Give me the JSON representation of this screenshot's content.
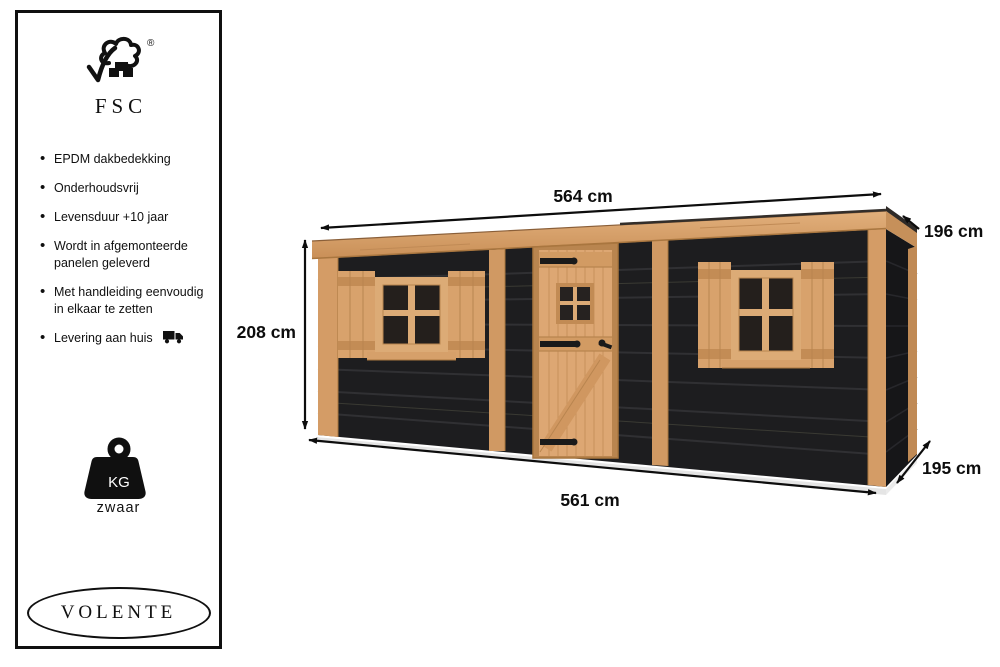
{
  "sidebar": {
    "certification": {
      "name": "FSC",
      "registered": "®"
    },
    "features": [
      {
        "text": "EPDM dakbedekking"
      },
      {
        "text": "Onderhoudsvrij"
      },
      {
        "text": "Levensduur +10 jaar"
      },
      {
        "text": "Wordt in afgemonteerde\npanelen geleverd"
      },
      {
        "text": "Met handleiding eenvoudig\nin elkaar te zetten"
      },
      {
        "text": "Levering aan huis"
      }
    ],
    "weight_badge": {
      "label": "KG",
      "caption": "zwaar"
    },
    "brand": "VOLENTE"
  },
  "diagram": {
    "dimensions": {
      "top_width": "564 cm",
      "rear_height": "196 cm",
      "front_height": "208 cm",
      "bottom_width": "561 cm",
      "depth": "195 cm"
    },
    "colors": {
      "wood": "#d6a06b",
      "wall_dark": "#1d1d1f",
      "annotation": "#0d0d0d"
    }
  }
}
